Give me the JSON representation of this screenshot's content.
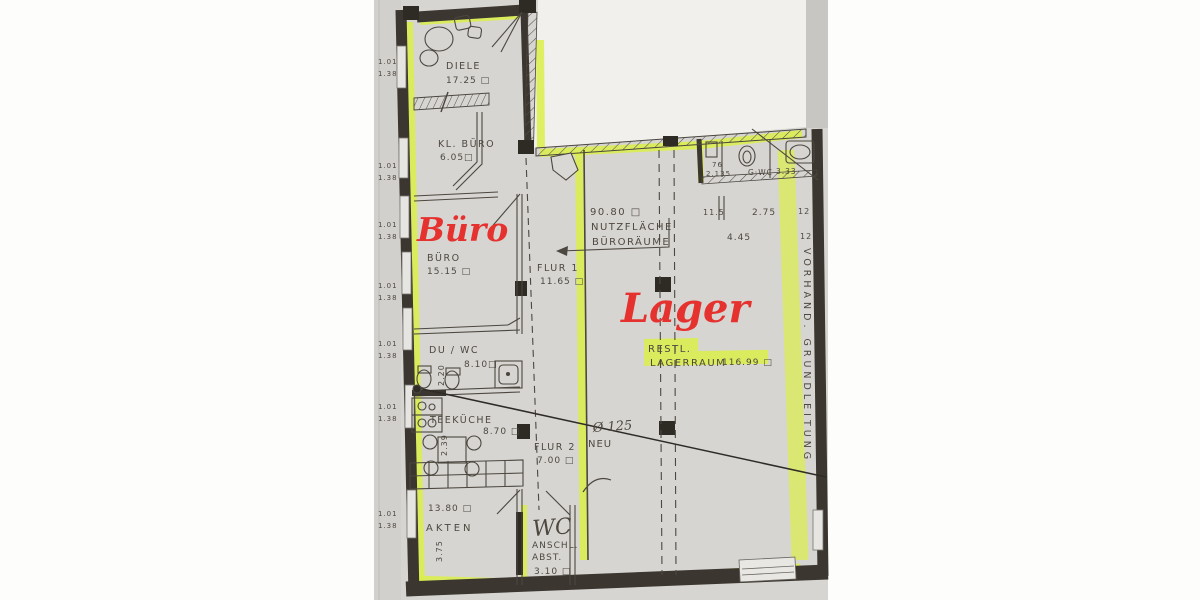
{
  "plan": {
    "red": {
      "buero": "Büro",
      "lager": "Lager"
    },
    "rooms": {
      "diele": {
        "name": "DIELE",
        "area": "17.25 □"
      },
      "kl_buero": {
        "name": "KL. BÜRO",
        "area": "6.05□"
      },
      "buero": {
        "name": "BÜRO",
        "area": "15.15 □"
      },
      "flur1": {
        "name": "FLUR 1",
        "area": "11.65 □"
      },
      "du_wc": {
        "name": "DU / WC",
        "area": "8.10□",
        "dim": "2.20"
      },
      "teekueche": {
        "name": "TEEKÜCHE",
        "area": "8.70 □",
        "dim": "2.39"
      },
      "flur2": {
        "name": "FLUR 2",
        "area": "7.00 □"
      },
      "akten": {
        "name": "AKTEN",
        "area": "13.80 □",
        "dim": "3.75"
      },
      "wc_abst": {
        "title": "WC",
        "line1": "ANSCHL.",
        "line2": "ABST.",
        "area": "3.10 □"
      },
      "g_wc": {
        "name": "G·WC",
        "area": "3.33"
      }
    },
    "notes": {
      "nutz": {
        "l1": "90.80 □",
        "l2": "NUTZFLÄCHE",
        "l3": "BÜRORÄUME"
      },
      "rest": {
        "l1": "RESTL.",
        "l2": "LAGERRAUM",
        "area": "116.99 □"
      },
      "vorhand": "VORHAND.  GRUNDLEITUNG",
      "pipe": {
        "dia": "Ø 125",
        "label": "NEU"
      }
    },
    "dims": {
      "window": {
        "a": "1.01",
        "b": "1.38"
      },
      "gwc": {
        "a": "76",
        "b": "2.135"
      },
      "lager": {
        "d1": "11.5",
        "d2": "2.75",
        "d3": "4.45",
        "r1": "12",
        "r2": "12"
      }
    },
    "colors": {
      "highlight": "#dcee4a",
      "marker_red": "#e5322e",
      "wall": "#3b362f",
      "paper": "#d6d5d2"
    }
  }
}
